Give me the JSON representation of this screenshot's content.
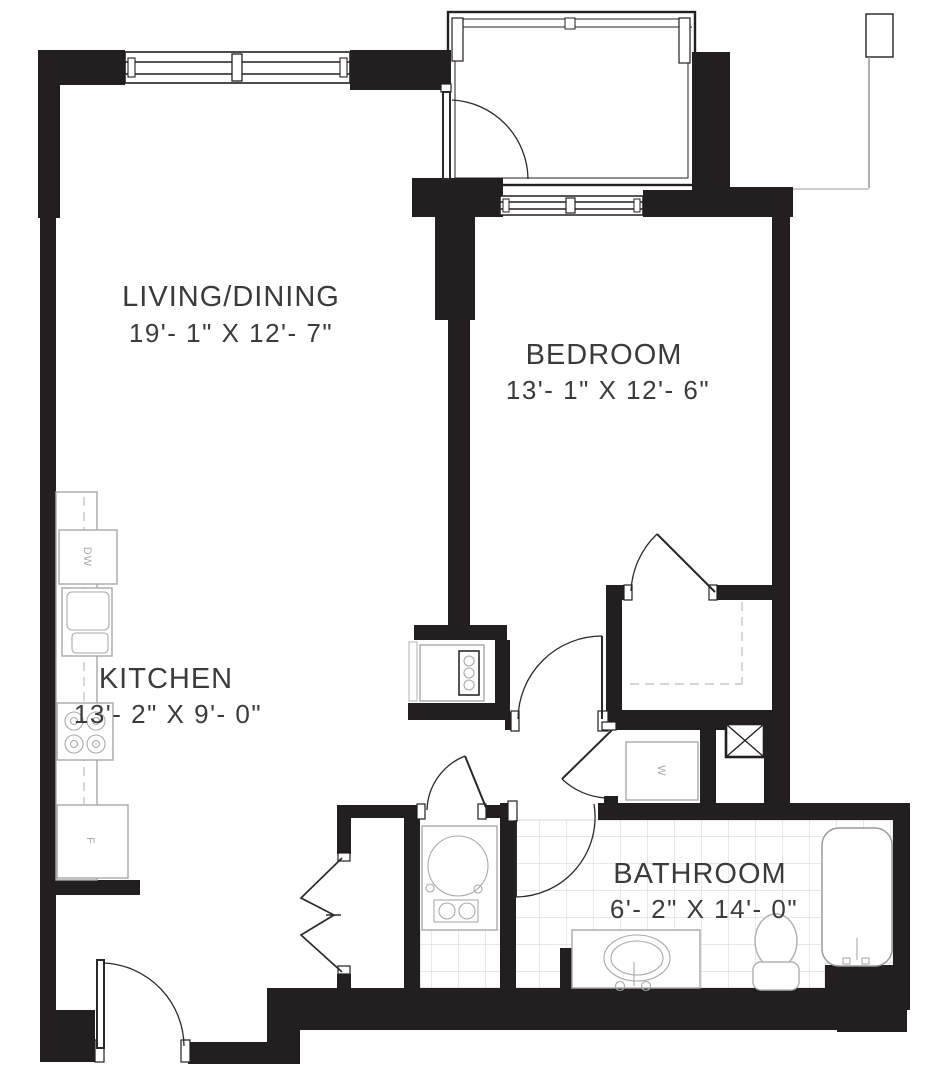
{
  "rooms": {
    "living": {
      "name": "LIVING/DINING",
      "dims": "19'- 1\" X 12'- 7\""
    },
    "bedroom": {
      "name": "BEDROOM",
      "dims": "13'- 1\" X 12'- 6\""
    },
    "kitchen": {
      "name": "KITCHEN",
      "dims": "13'- 2\" X  9'- 0\""
    },
    "bathroom": {
      "name": "BATHROOM",
      "dims": "6'- 2\" X  14'- 0\""
    }
  },
  "appliances": {
    "dishwasher": "DW",
    "refrigerator": "F",
    "washer": "W"
  },
  "colors": {
    "wall": "#231f20",
    "fixture_outline": "#a9a9a9",
    "tile_grid": "#d2d2d2",
    "label_text": "#3b3b3b",
    "background": "#ffffff"
  }
}
